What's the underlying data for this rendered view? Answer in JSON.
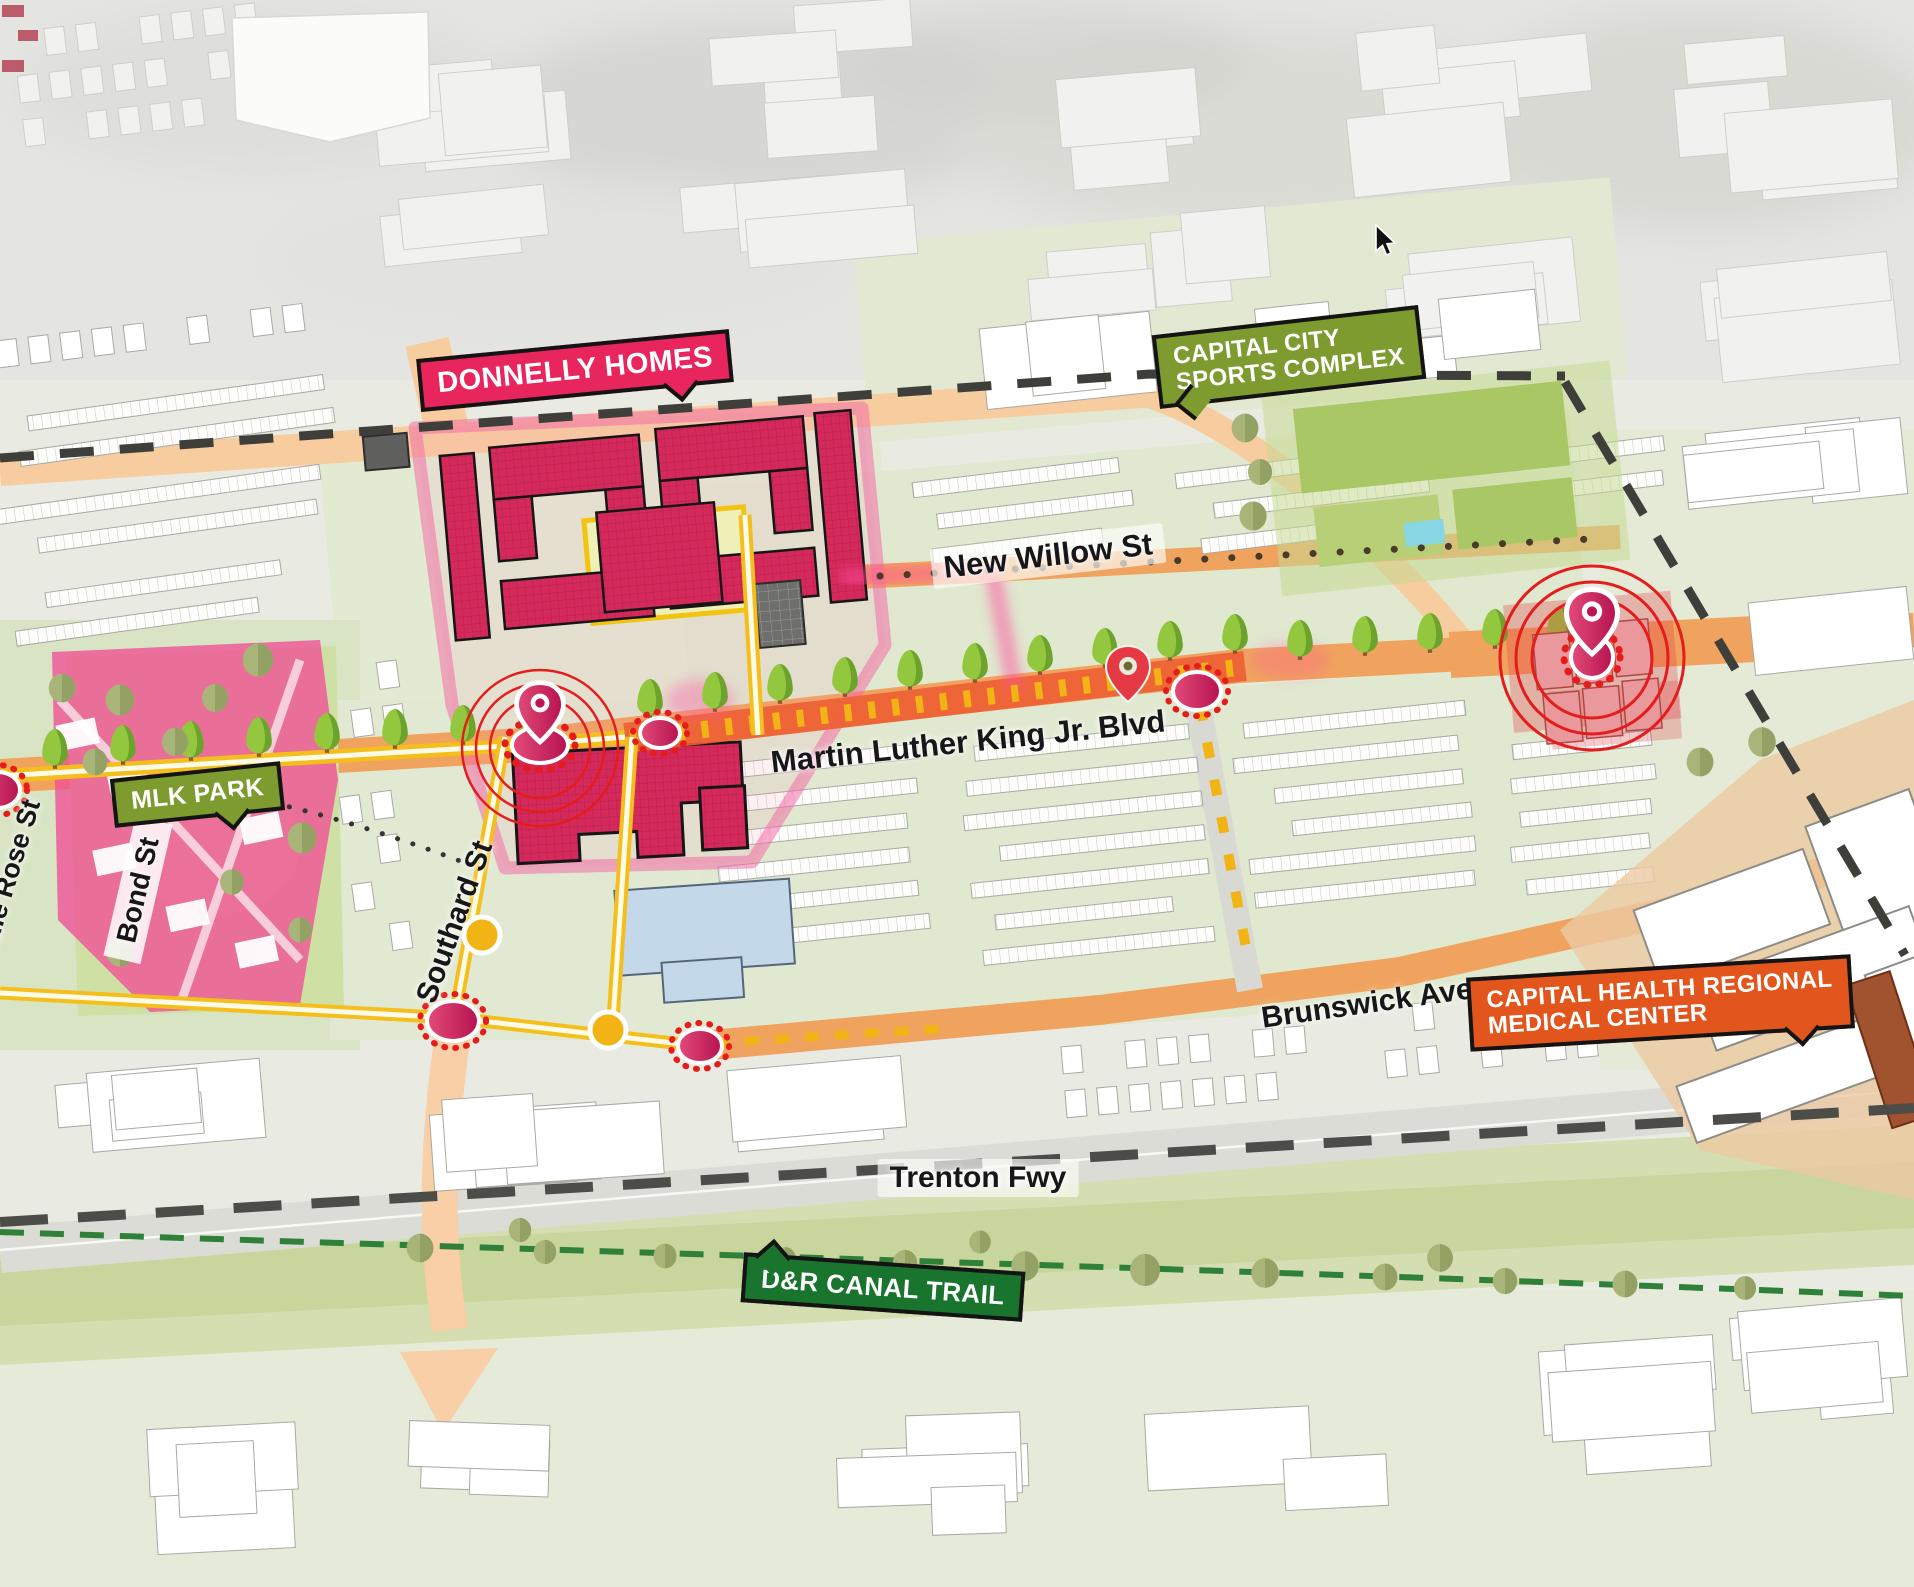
{
  "map": {
    "callouts": {
      "donnelly_homes": {
        "label": "DONNELLY HOMES",
        "color": "#e8255d"
      },
      "sports_complex": {
        "line1": "CAPITAL CITY",
        "line2": "SPORTS COMPLEX",
        "color": "#7e9b2f"
      },
      "mlk_park": {
        "label": "MLK PARK",
        "color": "#7e9b2f"
      },
      "medical_center": {
        "line1": "CAPITAL HEALTH REGIONAL",
        "line2": "MEDICAL CENTER",
        "color": "#e2551c"
      },
      "canal_trail": {
        "label": "D&R CANAL TRAIL",
        "color": "#19742e"
      }
    },
    "streets": {
      "new_willow": "New Willow St",
      "mlk_blvd": "Martin Luther King Jr. Blvd",
      "brunswick": "Brunswick Ave",
      "trenton_fwy": "Trenton Fwy",
      "southard": "Southard St",
      "bond": "Bond St",
      "middle_rose": "Middle Rose St"
    },
    "colors": {
      "route_yellow": "#f4bf1c",
      "road_orange": "#f0a35e",
      "road_peach": "#f7cc9e",
      "highlight_red_orange": "#ed5f33",
      "housing_crimson": "#d4295b",
      "overlay_magenta": "#ee4f9a",
      "marker_red": "#e51c1c",
      "marker_pink": "#cf1f5e",
      "park_green": "#cfe0a4",
      "field_green": "#aecb70",
      "trail_green": "#19742e"
    }
  }
}
